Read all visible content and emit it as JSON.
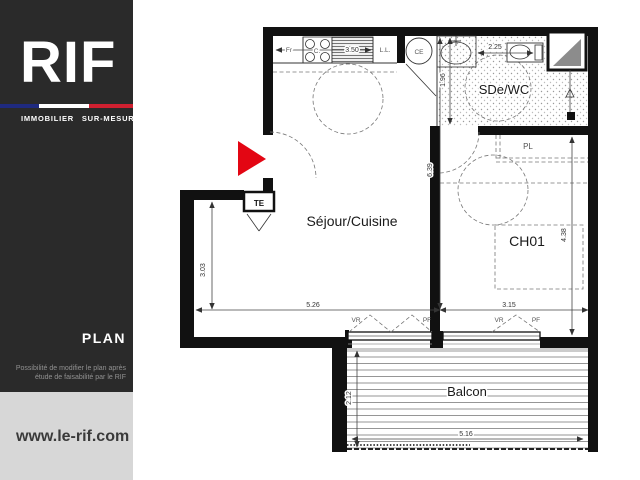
{
  "sidebar": {
    "logo": "RIF",
    "tagline": "IMMOBILIER SUR-MESURE",
    "section_title": "PLAN",
    "note_line1": "Possibilité de modifier le plan après",
    "note_line2": "étude de faisabilité par le RIF",
    "website": "www.le-rif.com",
    "colors": {
      "background": "#2a2a2a",
      "footer": "#d7d7d7",
      "flag_blue": "#1f2a7f",
      "flag_white": "#ffffff",
      "flag_red": "#cf2030"
    }
  },
  "plan": {
    "rooms": {
      "living": "Séjour/Cuisine",
      "shower": "SDe/WC",
      "bedroom": "CH01",
      "balcony": "Balcon",
      "closet": "PL",
      "electrical_panel": "TE"
    },
    "appliances": {
      "fridge": "Fr",
      "cooktop": "C.",
      "washer": "L.L.",
      "water_heater": "CE"
    },
    "windows": {
      "shutter": "VR",
      "french_door": "PF"
    },
    "dimensions": {
      "kitchen_run": "3.50",
      "shower_width": "2.25",
      "shower_depth": "1.96",
      "living_height": "6.39",
      "living_left": "3.03",
      "living_width": "5.26",
      "bedroom_width": "3.15",
      "bedroom_height": "4.38",
      "balcony_depth": "2.12",
      "balcony_width": "5.16"
    },
    "colors": {
      "wall": "#111111",
      "entrance_marker": "#e30613",
      "shaft_fill": "#8c8c8c"
    }
  }
}
